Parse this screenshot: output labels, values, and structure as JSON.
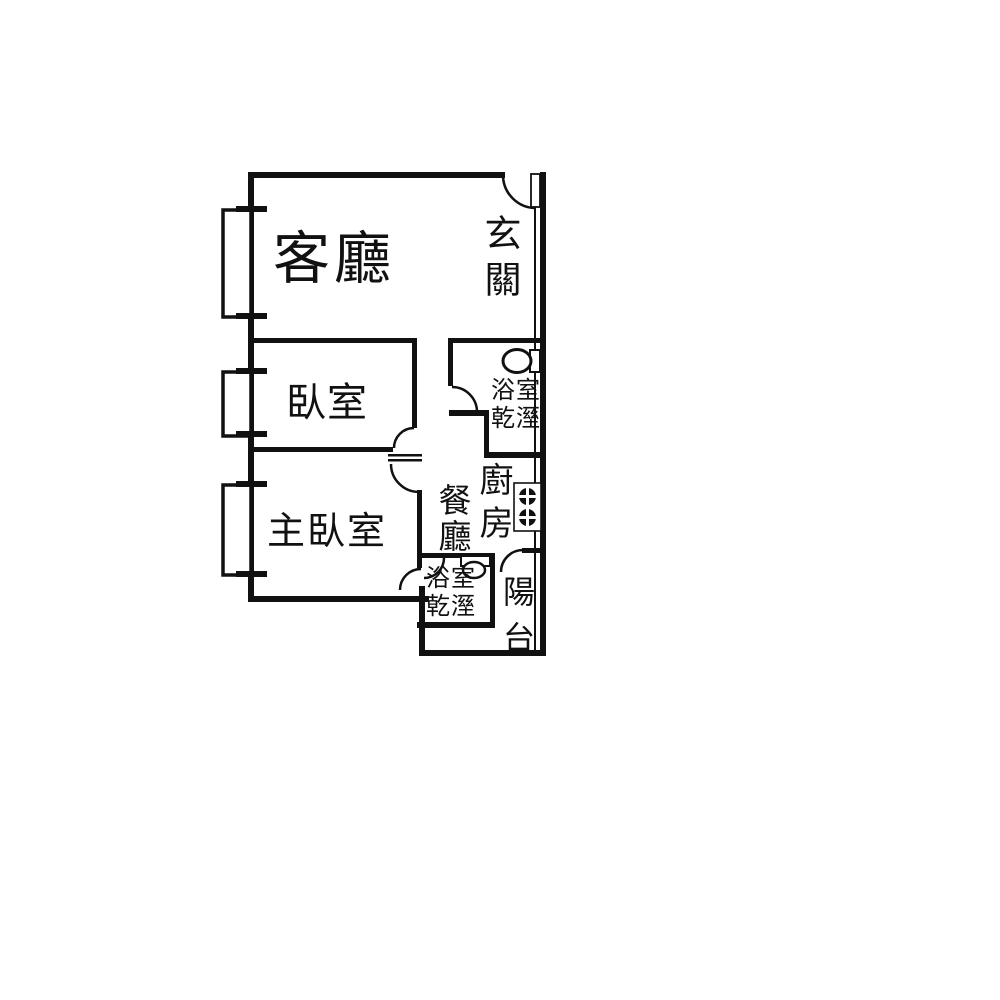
{
  "page": {
    "background_color": "#ffffff",
    "line_color": "#111111",
    "type": "apartment floor plan"
  },
  "rooms": {
    "living_room": {
      "label": "客廳"
    },
    "entryway": {
      "label": "玄關"
    },
    "bedroom": {
      "label": "臥室"
    },
    "master_bedroom": {
      "label": "主臥室"
    },
    "dining_room": {
      "label": "餐廳"
    },
    "kitchen": {
      "label": "廚房"
    },
    "bathroom_upper": {
      "label": "浴室乾溼"
    },
    "bathroom_lower": {
      "label": "浴室乾溼"
    },
    "balcony": {
      "label": "陽台"
    }
  },
  "fixtures": {
    "toilet": "toilet-icon",
    "stove": "stove-two-burner-icon",
    "sink": "sink-icon",
    "entry_door": "door-swing-icon",
    "windows": [
      "window-living",
      "window-bedroom",
      "window-master"
    ]
  }
}
